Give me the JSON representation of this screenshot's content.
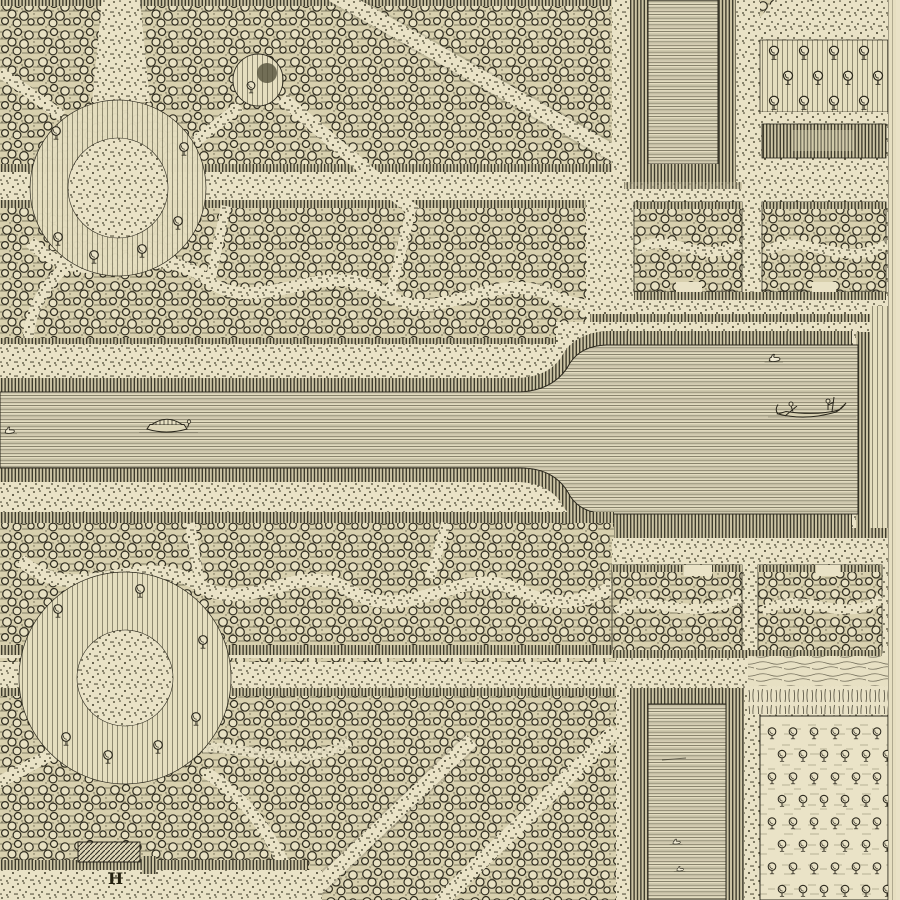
{
  "artwork": {
    "description": "Detail of an antique engraved formal garden plan: bosquets with winding stippled paths, two circular rond-points, a long canal widening into a basin with swans and boats, two rectangular pools and orchard tree grids"
  },
  "labels": {
    "key_letter": "H"
  },
  "palette": {
    "paper": "#e9e2c6",
    "ink": "#2b281d",
    "bosquet_ground": "#d8d0ae",
    "hedge_bank": "#cdc5a5",
    "water_line": "#55513d"
  },
  "features": {
    "swans_in_canal": 1,
    "swans_in_basin": 1,
    "swans_in_lower_pool": 2,
    "boats": [
      {
        "type": "covered barge",
        "location": "canal"
      },
      {
        "type": "rowboat with two figures",
        "location": "basin"
      }
    ]
  },
  "orchards": {
    "upper": {
      "rows": 3,
      "cols": 4
    },
    "lower": {
      "rows": 8,
      "cols": 6
    }
  }
}
